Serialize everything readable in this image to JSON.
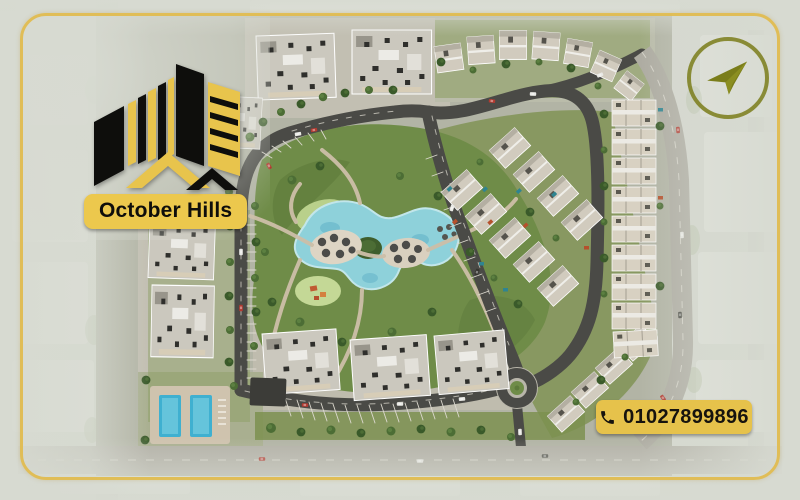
{
  "brand": {
    "name": "October Hills"
  },
  "contact": {
    "phone": "01027899896"
  },
  "icons": {
    "logo": "black-and-gold-buildings-mark",
    "compass": "paper-plane",
    "phone": "telephone-handset"
  },
  "palette": {
    "gold": "#E7C24D",
    "frame_gold": "#E0BC50",
    "logo_black": "#0E0E0C",
    "olive": "#7A7D1A",
    "park_green": "#6F8C48",
    "lagoon_blue": "#8FD0DA",
    "road_dark": "#4A4A46",
    "building_gray": "#CBC8BE",
    "background_wash": "#D7DAD1"
  },
  "scene": {
    "type": "aerial-masterplan-render",
    "visible_features": [
      "central-park-with-lagoon",
      "apartment-blocks",
      "villa-rows",
      "townhouse-strip",
      "loop-road-with-parking",
      "roundabout",
      "swimming-pools",
      "perimeter-roads",
      "faded-surrounding-city"
    ]
  }
}
